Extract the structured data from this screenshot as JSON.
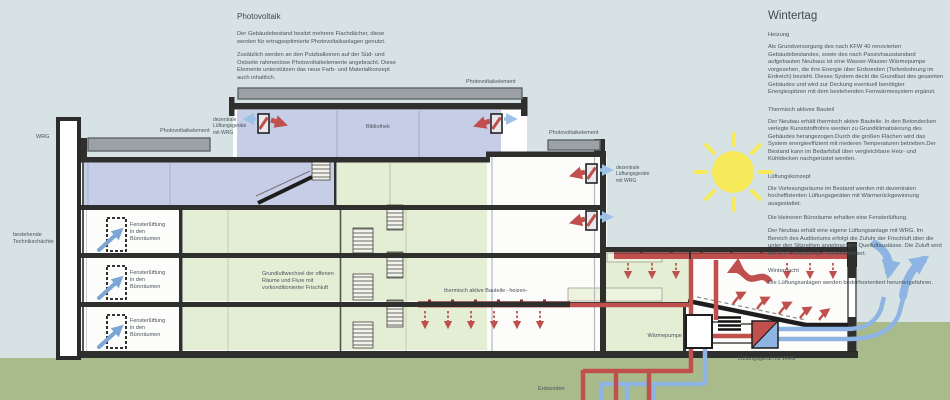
{
  "colors": {
    "sky": "#d6e2e3",
    "ground": "#a9ba8b",
    "room_lavender": "#c6cde7",
    "room_green": "#e4eed4",
    "panel_light_green": "#eef3e0",
    "slab_dark": "#2f2f2d",
    "pipe_red": "#c0504d",
    "pipe_blue": "#8db4e2",
    "pv_gray": "#9ba1a5",
    "sun_yellow": "#f6ea5a",
    "text": "#49535d"
  },
  "pv_text": {
    "title": "Photovoltaik",
    "p1": "Der Gebäudebestand besitzt mehrere Flachdächer, diese werden für ertragsoptimierte Photovoltaikanlagen genutzt.",
    "p2": "Zusätzlich werden an den Putzbalkonen auf der Süd- und Ostseite rahmenlose Photovoltaikelemente angebracht. Diese Elemente unterstützen das neue Farb- und Materialkonzept auch inhaltlich."
  },
  "winter_text": {
    "title": "Wintertag",
    "h1": "Heizung",
    "p1": "Als Grundversorgung des nach KFW 40 renovierten Gebäudebestandes, sowie des nach Passivhausstandard aufgebauten Neubaus ist eine Wasser-Wasser Wärmepumpe vorgesehen, die ihre Energie über Erdsonden (Tiefenbohrung im Erdreich) bezieht. Dieses System deckt die Grundlast des gesamten Gebäudes und wird zur Deckung eventuell benötigter Energiespitzen mit dem bestehenden Fernwärmesystem ergänzt.",
    "h2": "Thermisch aktives Bauteil",
    "p2": "Der Neubau erhält thermisch aktive Bauteile. In den Betondecken verlegte Kunststoffrohre werden zu Grundklimatisierung des Gebäudes herangezogen.Durch die großen Flächen wird das System energieeffizient mit niederen Temperaturen betrieben.Der Bestand kann im Bedarfsfall über vergleichbare Heiz- und Kühldecken nachgerüstet werden.",
    "h3": "Lüftungskonzept",
    "p3a": "Die Vorlesungsräume im Bestand werden mit dezentralen hocheffizienten Lüftungsgeräten mit Wärmerückgewinnung ausgestattet.",
    "p3b": "Die kleineren Büroräume erhalten eine Fensterlüftung.",
    "p3c": "Der Neubau erhält eine eigene Lüftungsanlage mit WRG. Im Bereich des Auditoriums erfolgt die Zufuhr der Frischluft über die unter den Sitzreihen angebrachten Quelluftauslässe. Die Zuluft wird mit der Wärmepumpe vorkonditioniert.",
    "h4": "Winternacht",
    "p4": "Die Lüftungsanlagen werden bedarfsorientiert heruntergefahren."
  },
  "diagram": {
    "wrg": "WRG",
    "technikschaechte": "bestehende Technikschächte",
    "pv_element": "Photovoltaikelement",
    "dezentral": "dezentrale Lüftungsgeräte mit WRG",
    "bibliothek": "Bibliothek",
    "fensterlueftung": "Fensterlüftung in den Büroräumen",
    "grundluftwechsel": "Grundluftwechsel der offenen Räume und Flure mit vorkonditionierter Frischluft",
    "thermisch": "thermisch aktive Bauteile",
    "heizen": "- heizen-",
    "waermepumpe": "Wärmepumpe",
    "lueftungsgeraet": "Lüftungsgerät mit WRG",
    "erdsonden": "Erdsonden"
  }
}
